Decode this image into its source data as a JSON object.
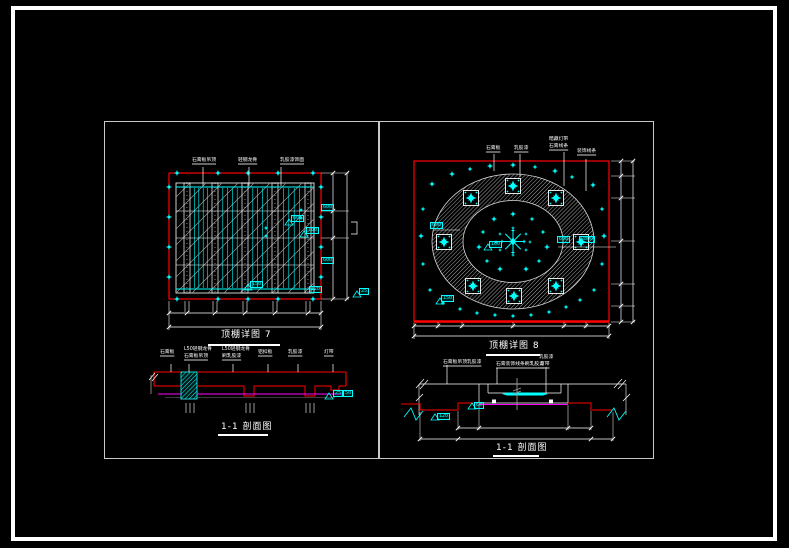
{
  "colors": {
    "line_red": "#ff0000",
    "accent_cyan": "#00ffff",
    "line_magenta": "#ff00ff",
    "line_white": "#ffffff",
    "hatch_gray": "#b5b5b5"
  },
  "left": {
    "plan": {
      "callouts": [
        "石膏板吊顶",
        "轻钢龙骨",
        "乳胶漆饰面"
      ],
      "caption": "顶棚详图 7",
      "edge_tags": [
        "600",
        "600",
        "120"
      ],
      "tri_tags": [
        "600",
        "100",
        "150",
        "25"
      ]
    },
    "section": {
      "callouts": [
        "石膏板",
        "L50轻钢龙骨",
        "石膏板吊顶",
        "L50轻钢龙骨",
        "刷乳胶漆",
        "铝扣板",
        "乳胶漆",
        "灯带"
      ],
      "tags": [
        "25",
        "50"
      ],
      "caption": "1-1 剖面图"
    }
  },
  "right": {
    "plan": {
      "callouts": [
        "石膏板",
        "乳胶漆",
        "暗藏灯带",
        "石膏线条",
        "装饰线条"
      ],
      "dim_tags": [
        "600",
        "2800",
        "600"
      ],
      "tri_tags": [
        "100",
        "150"
      ],
      "caption": "顶棚详图 8"
    },
    "section": {
      "callouts": [
        "石膏板吊顶乳胶漆",
        "石膏装饰线条刷乳胶漆",
        "乳胶漆",
        "灯带"
      ],
      "tri_tags": [
        "60",
        "120"
      ],
      "caption": "1-1 剖面图"
    }
  }
}
